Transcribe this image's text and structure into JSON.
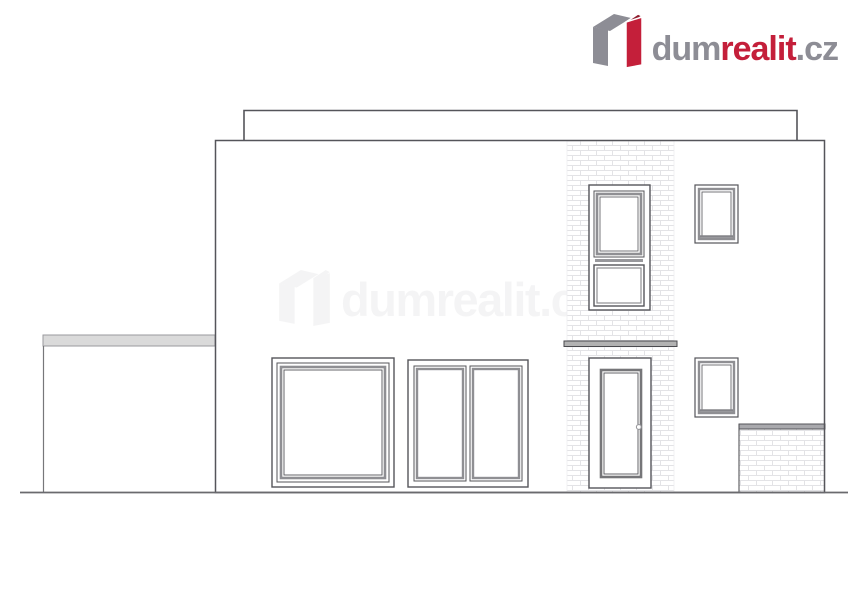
{
  "brand": {
    "name_parts": {
      "dum": "dum",
      "realit": "realit",
      "tld": ".cz"
    },
    "colors": {
      "gray": "#8d8d95",
      "red": "#c41f3a",
      "dark_red": "#8f1d2e"
    }
  },
  "watermark": {
    "name_parts": {
      "dum": "dum",
      "realit": "realit",
      "tld": ".cz"
    },
    "opacity": "0.05"
  },
  "drawing": {
    "kind": "architectural front elevation of a two-storey flat-roof house",
    "colors": {
      "outline": "#55555a",
      "frame_gray": "#8f8f93",
      "mortar": "#e3e3e6",
      "slab_band": "#b2b2b2",
      "garage_band": "#dadada",
      "fence_cap": "#a9a9ad"
    },
    "elements": {
      "roof_parapet": "roof parapet",
      "main_facade": "main facade wall",
      "garage_wall": "low side garage wall",
      "brick_pier": "clinker brick pier",
      "floor_band": "floor slab band",
      "large_window": "large square window",
      "double_window": "two-pane window",
      "tall_upper_window": "tall upper window",
      "upper_small_window": "small upper window",
      "lower_small_window": "small lower window",
      "entry_door": "entry door",
      "door_handle": "door handle",
      "brick_fence": "low brick fence wall",
      "ground_line": "ground line"
    }
  }
}
